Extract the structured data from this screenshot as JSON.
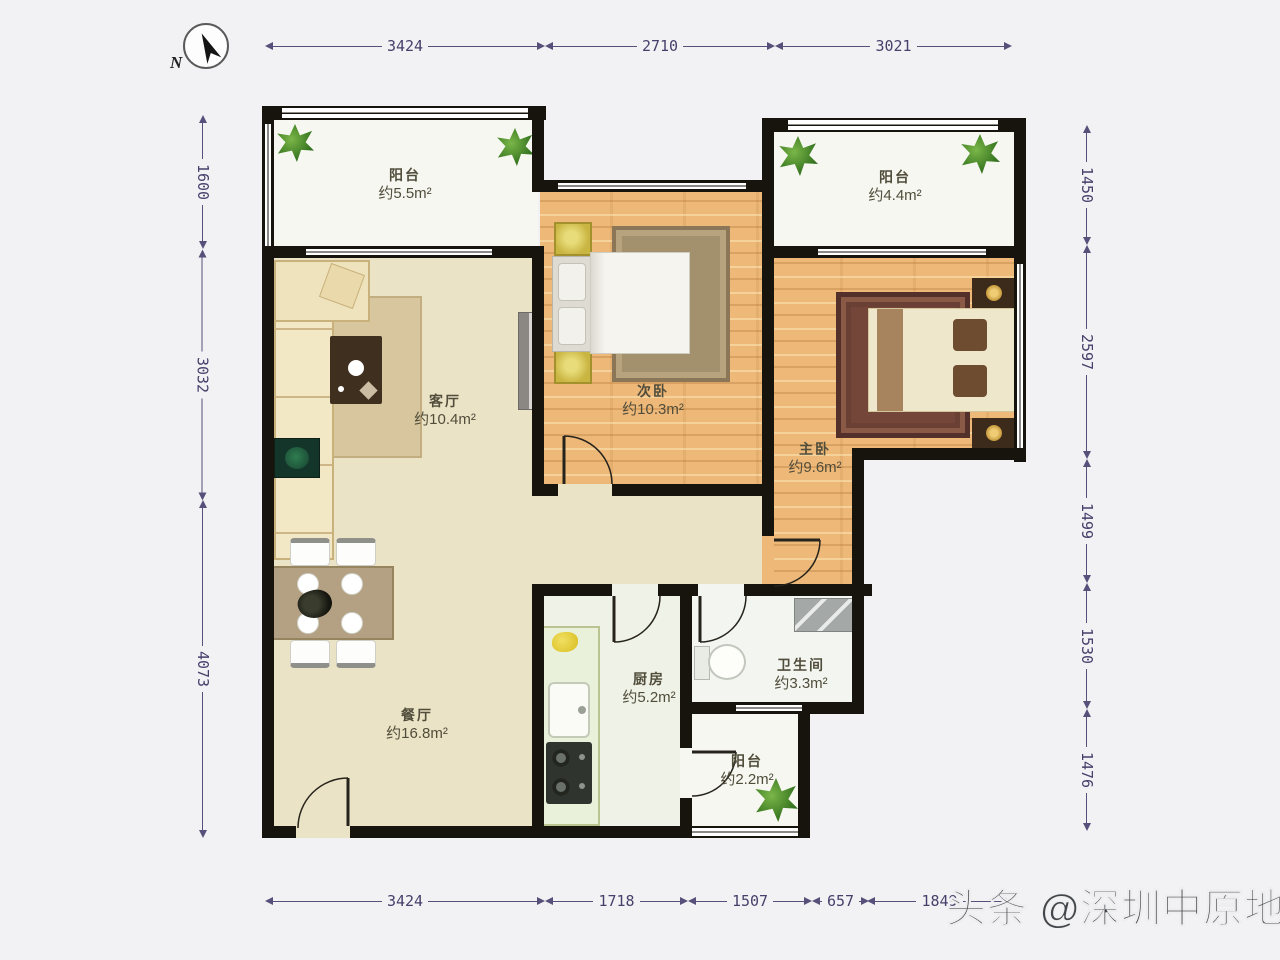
{
  "compass": {
    "label": "N"
  },
  "watermark": "头条 @深圳中原地产",
  "dimensions": {
    "top": [
      "3424",
      "2710",
      "3021"
    ],
    "bottom": [
      "3424",
      "1718",
      "1507",
      "657",
      "1849"
    ],
    "left": [
      "1600",
      "3032",
      "4073"
    ],
    "right": [
      "1450",
      "2597",
      "1499",
      "1530",
      "1476"
    ]
  },
  "rooms": [
    {
      "name": "阳台",
      "area": "约5.5m²"
    },
    {
      "name": "客厅",
      "area": "约10.4m²"
    },
    {
      "name": "次卧",
      "area": "约10.3m²"
    },
    {
      "name": "阳台",
      "area": "约4.4m²"
    },
    {
      "name": "主卧",
      "area": "约9.6m²"
    },
    {
      "name": "餐厅",
      "area": "约16.8m²"
    },
    {
      "name": "厨房",
      "area": "约5.2m²"
    },
    {
      "name": "卫生间",
      "area": "约3.3m²"
    },
    {
      "name": "阳台",
      "area": "约2.2m²"
    }
  ],
  "colors": {
    "wall": "#17140e",
    "wood_floor": "#edb878",
    "beige_floor": "#ebe3c6",
    "dimension_text": "#46406b"
  }
}
